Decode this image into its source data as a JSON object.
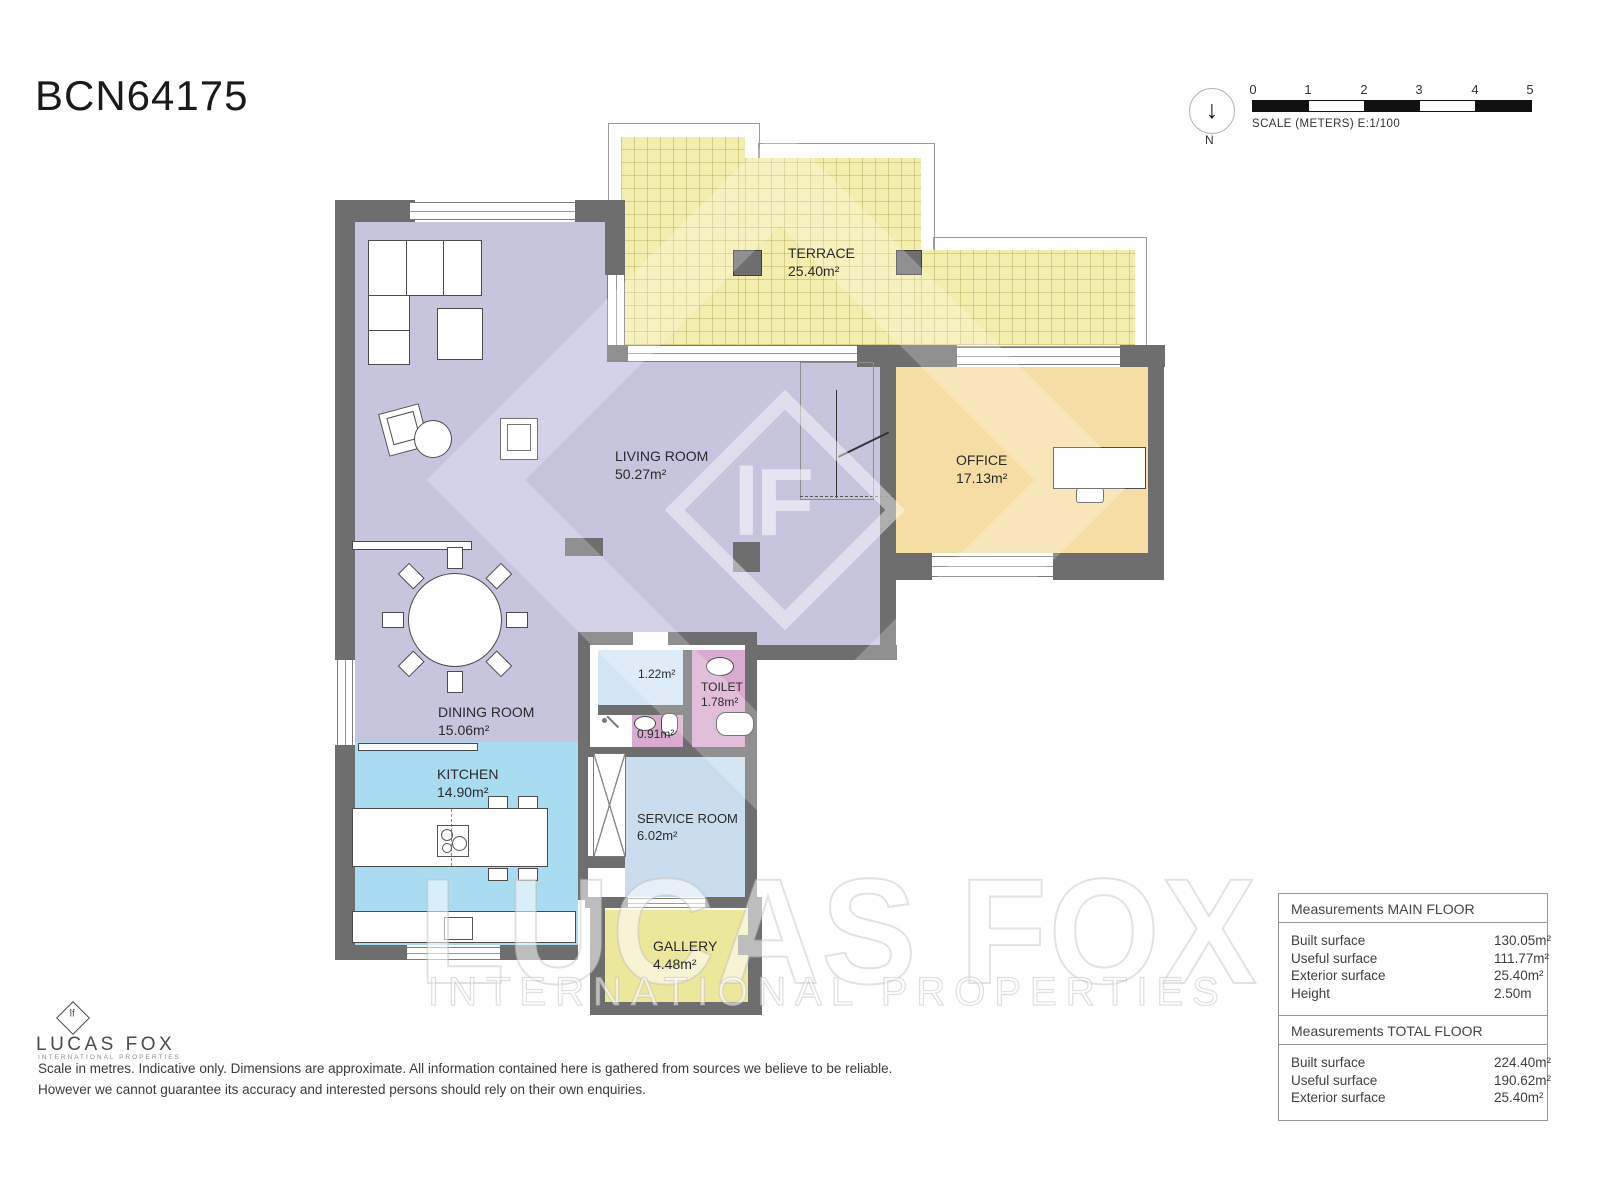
{
  "title": "BCN64175",
  "north": {
    "label": "N",
    "arrow": "↓"
  },
  "scalebar": {
    "ticks": [
      "0",
      "1",
      "2",
      "3",
      "4",
      "5"
    ],
    "caption": "SCALE (METERS) E:1/100"
  },
  "rooms": {
    "terrace": {
      "name": "TERRACE",
      "area": "25.40m²"
    },
    "living": {
      "name": "LIVING ROOM",
      "area": "50.27m²"
    },
    "office": {
      "name": "OFFICE",
      "area": "17.13m²"
    },
    "dining": {
      "name": "DINING ROOM",
      "area": "15.06m²"
    },
    "kitchen": {
      "name": "KITCHEN",
      "area": "14.90m²"
    },
    "storage": {
      "area": "1.22m²"
    },
    "toilet": {
      "name": "TOILET",
      "area": "1.78m²"
    },
    "wc": {
      "area": "0.91m²"
    },
    "service": {
      "name": "SERVICE ROOM",
      "area": "6.02m²"
    },
    "gallery": {
      "name": "GALLERY",
      "area": "4.48m²"
    }
  },
  "watermark": {
    "monogram": "lF",
    "line1": "LUCAS FOX",
    "line2": "INTERNATIONAL PROPERTIES"
  },
  "logo": {
    "monogram": "lf",
    "name": "LUCAS FOX",
    "subtitle": "INTERNATIONAL PROPERTIES"
  },
  "disclaimer": {
    "line1": "Scale in metres. Indicative only. Dimensions are approximate. All information contained here is gathered from sources we believe to be reliable.",
    "line2": "However we cannot guarantee its accuracy and interested persons should rely on their own enquiries."
  },
  "tables": [
    {
      "header": "Measurements MAIN FLOOR",
      "rows": [
        [
          "Built surface",
          "130.05m²"
        ],
        [
          "Useful surface",
          "111.77m²"
        ],
        [
          "Exterior surface",
          "25.40m²"
        ],
        [
          "Height",
          "2.50m"
        ]
      ]
    },
    {
      "header": "Measurements TOTAL FLOOR",
      "rows": [
        [
          "Built surface",
          "224.40m²"
        ],
        [
          "Useful surface",
          "190.62m²"
        ],
        [
          "Exterior surface",
          "25.40m²"
        ]
      ]
    }
  ],
  "colors": {
    "wall": "#6e6e6e",
    "terrace": "#f2eead",
    "living": "#c7c4de",
    "office": "#f6dda4",
    "kitchen": "#a9dcf1",
    "service": "#c9ddee",
    "storage": "#d4e6f6",
    "toilet": "#d9abce",
    "gallery": "#ebe79b"
  }
}
